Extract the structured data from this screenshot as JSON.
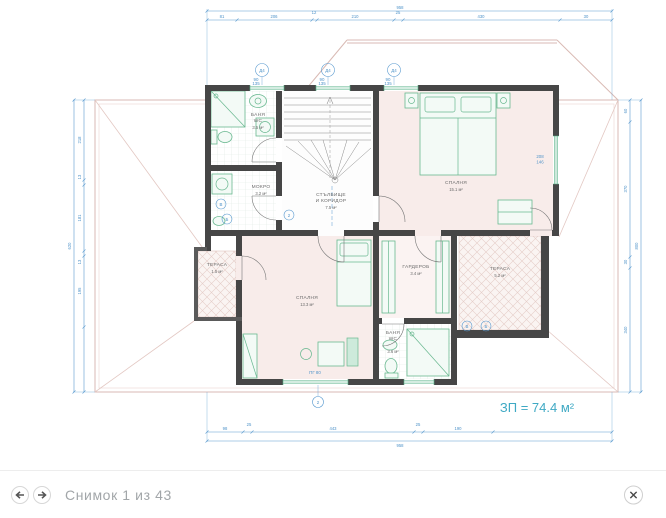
{
  "viewer": {
    "caption": "Снимок 1 из 43",
    "icons": {
      "prev": "arrow-left-icon",
      "next": "arrow-right-icon",
      "close": "close-icon"
    }
  },
  "plan": {
    "total_area": "ЗП = 74.4 м²",
    "rooms": {
      "bath_top": {
        "name": "БАНЯ",
        "sub": "WC",
        "area": "3.5 м²"
      },
      "mokro": {
        "name": "МОКРО",
        "area": "3.2 м²"
      },
      "stairs": {
        "name": "СТЪЛБИЩЕ",
        "sub": "И КОРИДОР",
        "area": "7.5 м²"
      },
      "bedroom_main": {
        "name": "СПАЛНЯ",
        "area": "15.1 м²"
      },
      "bedroom_second": {
        "name": "СПАЛНЯ",
        "area": "13.3 м²"
      },
      "wardrobe": {
        "name": "ГАРДЕРОБ",
        "area": "3.4 м²"
      },
      "terrace_right": {
        "name": "ТЕРАСА",
        "area": "5.2 м²"
      },
      "terrace_left": {
        "name": "ТЕРАСА",
        "area": "1.5 м²"
      },
      "bath_bottom": {
        "name": "БАНЯ",
        "sub": "WC",
        "area": "3.6 м²"
      }
    },
    "dimensions": {
      "top_total": "958",
      "top": [
        "81",
        "206",
        "12",
        "210",
        "25",
        "430",
        "30"
      ],
      "bottom": [
        "98",
        "25",
        "443",
        "25",
        "190"
      ],
      "bottom_total": "958",
      "left": [
        "218",
        "13",
        "181",
        "13",
        "195"
      ],
      "left_total": "620",
      "right": [
        "60",
        "370",
        "30",
        "340"
      ],
      "right_total": "800"
    },
    "markers": {
      "window_label": "Д4",
      "window_w": "90",
      "window_h": "135",
      "right_window_w": "208",
      "right_window_h": "146",
      "door_note": "ПГ 80",
      "c1": "В",
      "c2": "Б",
      "c3": "2",
      "c4": "В",
      "c5": "Б",
      "c6": "2"
    },
    "colors": {
      "dimension_blue": "#5b9bd0",
      "wall_dark": "#464646",
      "furniture_green": "#69b890",
      "roof_rose": "#d9bab4",
      "room_pink": "#f8ecea",
      "area_label_teal": "#3fa9c4"
    }
  }
}
